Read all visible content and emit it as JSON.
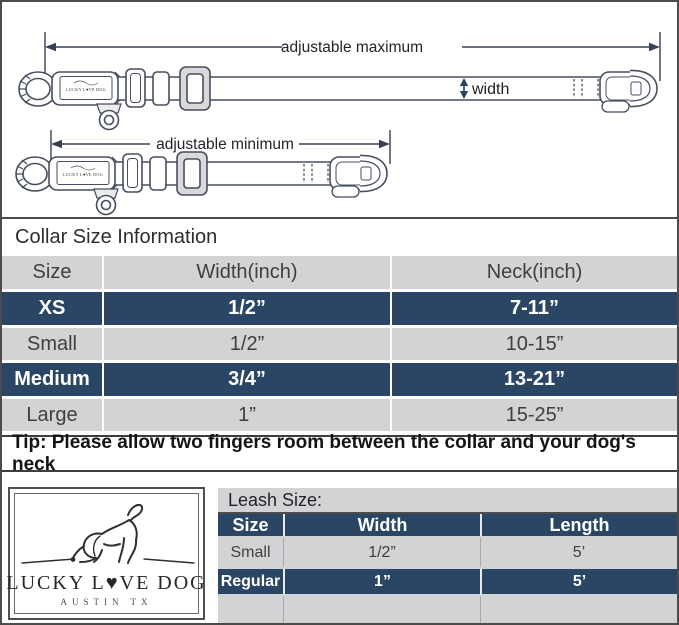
{
  "colors": {
    "navy_row": "#2a4664",
    "gray_row": "#d3d3d6",
    "border": "#4b4b4b",
    "diagram_line": "#474e60",
    "width_arrow_navy": "#2c3f66"
  },
  "diagram": {
    "max_label": "adjustable maximum",
    "min_label": "adjustable minimum",
    "width_label": "width",
    "buckle_brand": "LUCKY L♥VE DOG"
  },
  "collar_section": {
    "title": "Collar Size Information",
    "headers": [
      "Size",
      "Width(inch)",
      "Neck(inch)"
    ],
    "rows": [
      {
        "size": "XS",
        "width": "1/2”",
        "neck": "7-11”",
        "highlight": true
      },
      {
        "size": "Small",
        "width": "1/2”",
        "neck": "10-15”",
        "highlight": false
      },
      {
        "size": "Medium",
        "width": "3/4”",
        "neck": "13-21”",
        "highlight": true
      },
      {
        "size": "Large",
        "width": "1”",
        "neck": "15-25”",
        "highlight": false
      }
    ],
    "tip": "Tip: Please allow two fingers room between the collar and your dog's neck"
  },
  "logo": {
    "brand_line": "LUCKY L♥VE DOG",
    "city": "AUSTIN TX"
  },
  "leash_section": {
    "title": "Leash Size:",
    "headers": [
      "Size",
      "Width",
      "Length"
    ],
    "rows": [
      {
        "size": "Small",
        "width": "1/2”",
        "length": "5’",
        "highlight": false
      },
      {
        "size": "Regular",
        "width": "1”",
        "length": "5’",
        "highlight": true
      }
    ]
  }
}
